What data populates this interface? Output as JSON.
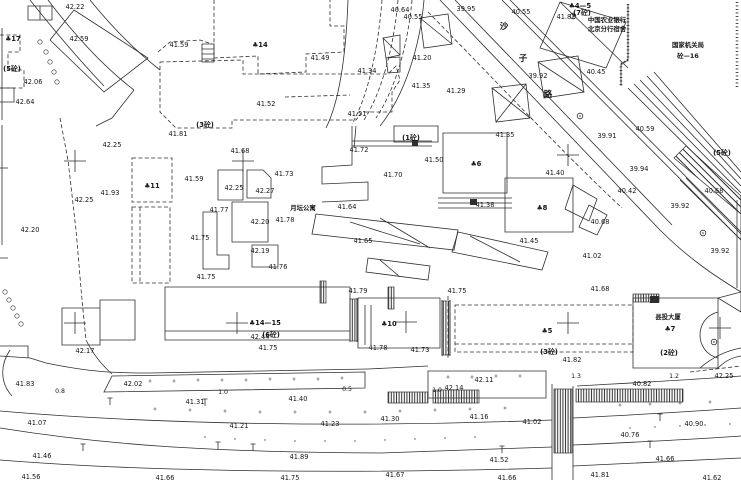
{
  "map": {
    "canvas": {
      "width": 741,
      "height": 480
    },
    "colors": {
      "background": "#ffffff",
      "ink": "#2f2f2f",
      "label": "#161616"
    },
    "spot_elevations": [
      [
        "42.22",
        75,
        6
      ],
      [
        "42.59",
        79,
        38
      ],
      [
        "42.06",
        33,
        81
      ],
      [
        "42.64",
        25,
        101
      ],
      [
        "41.59",
        179,
        44
      ],
      [
        "42.25",
        112,
        144
      ],
      [
        "41.81",
        178,
        133
      ],
      [
        "41.93",
        110,
        192
      ],
      [
        "42.20",
        30,
        229
      ],
      [
        "42.25",
        84,
        199
      ],
      [
        "42.17",
        85,
        350
      ],
      [
        "42.44",
        260,
        336
      ],
      [
        "41.78",
        378,
        347
      ],
      [
        "41.83",
        25,
        383
      ],
      [
        "42.02",
        133,
        383
      ],
      [
        "41.31",
        195,
        401
      ],
      [
        "41.40",
        298,
        398
      ],
      [
        "41.07",
        37,
        422
      ],
      [
        "41.21",
        239,
        425
      ],
      [
        "41.23",
        330,
        423
      ],
      [
        "41.46",
        42,
        455
      ],
      [
        "41.89",
        299,
        456
      ],
      [
        "41.56",
        31,
        476
      ],
      [
        "41.66",
        165,
        477
      ],
      [
        "41.75",
        290,
        477
      ],
      [
        "41.49",
        320,
        57
      ],
      [
        "41.52",
        266,
        103
      ],
      [
        "41.51",
        357,
        113
      ],
      [
        "40.64",
        400,
        9
      ],
      [
        "40.55",
        413,
        16
      ],
      [
        "41.34",
        367,
        70
      ],
      [
        "41.20",
        422,
        57
      ],
      [
        "41.35",
        421,
        85
      ],
      [
        "41.29",
        456,
        90
      ],
      [
        "39.95",
        466,
        8
      ],
      [
        "41.72",
        359,
        149
      ],
      [
        "41.70",
        393,
        174
      ],
      [
        "41.64",
        347,
        206
      ],
      [
        "41.78",
        285,
        219
      ],
      [
        "41.65",
        363,
        240
      ],
      [
        "41.68",
        240,
        150
      ],
      [
        "41.59",
        194,
        178
      ],
      [
        "41.73",
        284,
        173
      ],
      [
        "42.25",
        234,
        187
      ],
      [
        "42.27",
        265,
        190
      ],
      [
        "41.77",
        219,
        209
      ],
      [
        "42.20",
        260,
        221
      ],
      [
        "41.75",
        200,
        237
      ],
      [
        "42.19",
        260,
        250
      ],
      [
        "41.76",
        278,
        266
      ],
      [
        "41.75",
        206,
        276
      ],
      [
        "40.55",
        521,
        11
      ],
      [
        "41.82",
        566,
        16
      ],
      [
        "39.92",
        538,
        75
      ],
      [
        "40.45",
        596,
        71
      ],
      [
        "40.59",
        645,
        128
      ],
      [
        "39.91",
        607,
        135
      ],
      [
        "41.35",
        505,
        134
      ],
      [
        "41.50",
        434,
        159
      ],
      [
        "41.40",
        555,
        172
      ],
      [
        "41.38",
        485,
        204
      ],
      [
        "41.45",
        529,
        240
      ],
      [
        "39.94",
        639,
        168
      ],
      [
        "40.42",
        627,
        190
      ],
      [
        "40.68",
        714,
        190
      ],
      [
        "39.92",
        680,
        205
      ],
      [
        "40.68",
        600,
        221
      ],
      [
        "41.02",
        592,
        255
      ],
      [
        "39.92",
        720,
        250
      ],
      [
        "41.68",
        600,
        288
      ],
      [
        "40.82",
        642,
        383
      ],
      [
        "41.30",
        390,
        418
      ],
      [
        "41.16",
        479,
        416
      ],
      [
        "41.02",
        532,
        421
      ],
      [
        "40.90",
        694,
        423
      ],
      [
        "40.76",
        630,
        434
      ],
      [
        "41.52",
        499,
        459
      ],
      [
        "41.66",
        665,
        458
      ],
      [
        "41.67",
        395,
        474
      ],
      [
        "41.66",
        507,
        477
      ],
      [
        "41.81",
        600,
        474
      ],
      [
        "41.62",
        712,
        477
      ],
      [
        "42.14",
        454,
        387
      ],
      [
        "42.11",
        484,
        379
      ],
      [
        "41.82",
        572,
        359
      ],
      [
        "41.73",
        420,
        349
      ],
      [
        "41.75",
        268,
        347
      ],
      [
        "41.79",
        358,
        290
      ],
      [
        "41.75",
        457,
        290
      ],
      [
        "42.25",
        724,
        375
      ]
    ],
    "building_labels": [
      [
        "♣17",
        13,
        38
      ],
      [
        "♣14",
        260,
        44
      ],
      [
        "♣11",
        152,
        185
      ],
      [
        "♣6",
        476,
        163
      ],
      [
        "♣8",
        542,
        207
      ],
      [
        "♣5",
        547,
        330
      ],
      [
        "♣10",
        389,
        323
      ],
      [
        "♣14—15",
        265,
        322
      ],
      [
        "♣7",
        670,
        328
      ],
      [
        "♣4—5",
        580,
        5
      ],
      [
        "(7砼)",
        582,
        12
      ],
      [
        "(5砼)",
        12,
        68
      ],
      [
        "(3砼)",
        205,
        124
      ],
      [
        "(1砼)",
        411,
        137
      ],
      [
        "(6砼)",
        271,
        334
      ],
      [
        "(3砼)",
        549,
        351
      ],
      [
        "(2砼)",
        669,
        352
      ],
      [
        "(5砼)",
        722,
        152
      ]
    ],
    "distance_labels": [
      [
        "0.8",
        60,
        390
      ],
      [
        "1.0",
        223,
        391
      ],
      [
        "0.5",
        347,
        388
      ],
      [
        "1.0",
        437,
        389
      ],
      [
        "1.3",
        576,
        375
      ],
      [
        "1.2",
        674,
        375
      ]
    ],
    "road_name_chars": [
      [
        "沙",
        504,
        26
      ],
      [
        "子",
        523,
        58
      ],
      [
        "路",
        548,
        94
      ]
    ],
    "text_blocks": [
      {
        "lines": [
          "中国农业银行",
          "北京分行宿舍"
        ],
        "x": 607,
        "y": 22,
        "lh": 9
      },
      {
        "lines": [
          "国家机关局",
          "砼—16"
        ],
        "x": 688,
        "y": 47,
        "lh": 11
      },
      {
        "lines": [
          "月坛公寓"
        ],
        "x": 303,
        "y": 210,
        "lh": 9
      },
      {
        "lines": [
          "县投大厦"
        ],
        "x": 668,
        "y": 319,
        "lh": 9
      }
    ],
    "grid_crosses": [
      [
        75,
        161
      ],
      [
        243,
        161
      ],
      [
        568,
        155
      ],
      [
        75,
        323
      ],
      [
        237,
        323
      ],
      [
        406,
        322
      ],
      [
        568,
        323
      ],
      [
        720,
        328
      ]
    ],
    "symbols": {
      "trees": [
        [
          573,
          16
        ],
        [
          580,
          116
        ],
        [
          703,
          233
        ],
        [
          714,
          342
        ]
      ],
      "lamps": [
        [
          110,
          402
        ],
        [
          205,
          403
        ],
        [
          83,
          448
        ],
        [
          218,
          446
        ],
        [
          253,
          448
        ],
        [
          502,
          450
        ],
        [
          650,
          445
        ],
        [
          660,
          418
        ]
      ],
      "plus_marks": [
        [
          150,
          381
        ],
        [
          174,
          381
        ],
        [
          198,
          380
        ],
        [
          222,
          380
        ],
        [
          246,
          380
        ],
        [
          270,
          379
        ],
        [
          294,
          379
        ],
        [
          318,
          379
        ],
        [
          342,
          378
        ],
        [
          448,
          377
        ],
        [
          472,
          377
        ],
        [
          496,
          376
        ],
        [
          520,
          376
        ],
        [
          155,
          409
        ],
        [
          190,
          410
        ],
        [
          225,
          411
        ],
        [
          260,
          412
        ],
        [
          295,
          412
        ],
        [
          330,
          412
        ],
        [
          365,
          412
        ],
        [
          400,
          411
        ],
        [
          435,
          410
        ],
        [
          470,
          409
        ],
        [
          505,
          408
        ],
        [
          620,
          405
        ],
        [
          650,
          404
        ],
        [
          680,
          403
        ],
        [
          710,
          402
        ]
      ],
      "dots": [
        [
          205,
          437
        ],
        [
          235,
          439
        ],
        [
          265,
          440
        ],
        [
          295,
          441
        ],
        [
          325,
          441
        ],
        [
          355,
          441
        ],
        [
          385,
          440
        ],
        [
          415,
          439
        ],
        [
          445,
          438
        ],
        [
          475,
          437
        ],
        [
          630,
          428
        ],
        [
          655,
          427
        ],
        [
          680,
          426
        ],
        [
          705,
          425
        ],
        [
          730,
          424
        ]
      ],
      "hedge_circles": [
        [
          40,
          42
        ],
        [
          46,
          52
        ],
        [
          50,
          62
        ],
        [
          54,
          72
        ],
        [
          57,
          82
        ],
        [
          5,
          292
        ],
        [
          9,
          300
        ],
        [
          13,
          308
        ],
        [
          17,
          316
        ],
        [
          21,
          324
        ]
      ]
    },
    "linework": {
      "solid": [
        "M 28,6 H 52 V 20 H 28 Z M 40,6 V 20",
        "M 48,0 Q 92,58 134,90",
        "M 30,0 Q 68,48 104,86",
        "M 90,0 Q 124,42 160,70",
        "M 134,90 L 112,118 L 96,126",
        "M 74,10 L 148,58 L 104,92 L 50,40 Z",
        "M 0,88 H 14 V 102 H 0",
        "M 202,44 H 214 V 62 H 202 Z M 202,49 H 214 M 202,54 H 214 M 202,59 H 214",
        "M 2,28 V 120",
        "M 2,125 V 245 M 0,168 H 8 M 0,258 H 8",
        "M 218,170 H 243 V 200 H 218 Z",
        "M 247,170 H 263 L 271,178 V 198 H 247 Z",
        "M 232,202 H 268 V 242 H 232 Z",
        "M 203,212 H 217 V 255 H 229 V 269 H 203 Z",
        "M 252,245 H 278 V 267 H 252 Z",
        "M 443,133 H 507 V 193 H 443 Z",
        "M 438,198 H 512 M 438,203 H 512 M 438,208 H 512",
        "M 505,178 H 573 V 232 H 505 Z",
        "M 573,185 L 597,199 L 589,221 L 565,209 Z M 589,205 L 607,215 L 597,235 L 579,227 Z",
        "M 352,126 V 165 L 322,167 V 184 L 368,182 V 200 L 322,202",
        "M 316,214 L 458,230 L 454,250 L 312,234 Z M 350,222 L 420,244 M 380,218 L 430,248",
        "M 458,232 L 548,252 L 542,270 L 452,252 Z M 470,236 L 520,262",
        "M 368,258 L 430,266 L 428,280 L 366,272 Z M 380,260 L 400,277",
        "M 440,0 L 660,230 C 690,260 718,278 741,292",
        "M 455,0 L 672,225",
        "M 502,0 L 741,240 M 510,0 L 741,232",
        "M 560,2 L 628,68",
        "M 628,88 L 741,200 M 634,84 L 741,193 M 640,80 L 741,186 M 647,76 L 741,179 M 654,72 L 741,172",
        "M 680,180 L 741,240 M 686,178 L 741,234",
        "M 560,2 L 626,22 L 606,68 L 540,48 Z",
        "M 348,0 C 346,55 340,100 326,128",
        "M 424,0 C 420,48 404,96 380,126",
        "M 356,126 L 354,148",
        "M 352,141 H 432 M 352,146 H 432",
        "M 394,126 H 438 V 142 H 394 Z",
        "M 383,38 L 400,35 L 400,55 L 386,58 Z M 386,58 L 400,57 L 400,72 L 388,73 Z M 383,38 L 400,55",
        "M 420,18 L 448,14 L 452,44 L 424,48 Z M 420,18 L 452,44",
        "M 492,88 L 526,84 L 530,118 L 496,122 Z M 492,88 L 530,118 M 526,84 L 496,122",
        "M 538,62 L 578,56 L 584,92 L 544,98 Z M 538,62 L 584,92",
        "M 633,298 H 718 V 368 H 633 Z M 718,312 C 694,318 694,352 718,358 M 718,298 L 741,292 L 741,312 Z M 700,368 C 715,355 730,350 741,348 M 718,368 C 726,360 734,357 741,356",
        "M 165,287 H 350 V 340 H 165 Z M 165,331 H 350",
        "M 358,298 H 440 V 348 H 358 Z",
        "M 350,298 V 342 M 357,298 V 342 M 442,300 V 356 M 450,300 V 356",
        "M 0,356 L 30,358 L 46,363 C 90,372 112,373 150,373 L 368,369",
        "M 112,376 L 365,372 L 365,388 L 104,392 Z",
        "M 368,369 L 428,366",
        "M 428,371 H 546 V 398 H 428 Z",
        "M 552,384 V 480 M 573,386 V 480",
        "M 577,386 C 630,383 690,380 741,376",
        "M 0,411 C 150,424 350,428 552,420 M 573,418 C 650,414 700,411 741,408",
        "M 0,428 C 100,444 200,452 380,453 L 552,447 M 573,445 C 640,442 700,439 741,436",
        "M 0,460 C 150,472 350,474 552,468 M 573,466 L 741,458",
        "M 10,350 C 0,365 0,383 12,396",
        "M 0,346 H 28 V 358",
        "M 62,308 H 100 V 345 H 62 Z M 100,300 H 135 V 340 H 100 Z",
        "M 365,305 V 345 M 371,305 V 345",
        "M 86,340 Q 96,360 112,374",
        "M 628,4 V 60 L 621,64 V 86",
        "M 741,195 V 292 M 737,200 V 288"
      ],
      "dashed": [
        "M 214,0 V 58 L 258,56 V 74 L 306,72 V 54 L 344,52 V 26 L 330,26 V 0",
        "M 160,62 L 243,60 L 243,74 L 388,74 L 396,66 L 400,80 L 392,92 L 392,112 L 362,112 L 356,120 L 232,120 L 232,128 L 176,128 L 160,112 Z",
        "M 158,52 L 170,42 L 200,40 L 212,44",
        "M 132,158 H 172 V 202 H 132 Z M 132,207 H 170 V 283 H 132 Z M 140,207 V 283",
        "M 0,35 H 20 V 52 H 8 V 70 H 24 V 88 H 0",
        "M 60,118 L 68,160 L 76,230 L 82,300 L 86,340",
        "M 382,0 C 378,50 368,96 352,124 M 398,0 C 394,46 382,92 364,120 M 412,0 C 408,44 396,88 376,118",
        "M 455,305 H 633 V 352 H 455 Z M 455,344 H 633",
        "M 428,12 C 500,85 560,150 622,208",
        "M 690,372 L 741,366",
        "M 448,296 V 360",
        "M 285,97 L 350,95"
      ],
      "tick_lines": [
        "M 628,4 V 60 L 621,64 V 86",
        "M 737,2 V 88"
      ],
      "hatch_rects": [
        [
          388,
          392,
          40,
          11
        ],
        [
          433,
          390,
          46,
          13
        ],
        [
          576,
          389,
          107,
          13
        ],
        [
          554,
          389,
          18,
          64
        ],
        [
          350,
          299,
          7,
          42
        ],
        [
          442,
          301,
          8,
          54
        ],
        [
          320,
          281,
          6,
          22
        ],
        [
          388,
          287,
          6,
          22
        ],
        [
          633,
          294,
          26,
          8
        ]
      ],
      "hatch_paths": [
        "M 686,146 L 741,196 L 741,214 L 674,158 Z"
      ],
      "dark_rects": [
        [
          470,
          199,
          7,
          6
        ],
        [
          650,
          296,
          9,
          7
        ],
        [
          412,
          140,
          6,
          6
        ]
      ]
    }
  }
}
